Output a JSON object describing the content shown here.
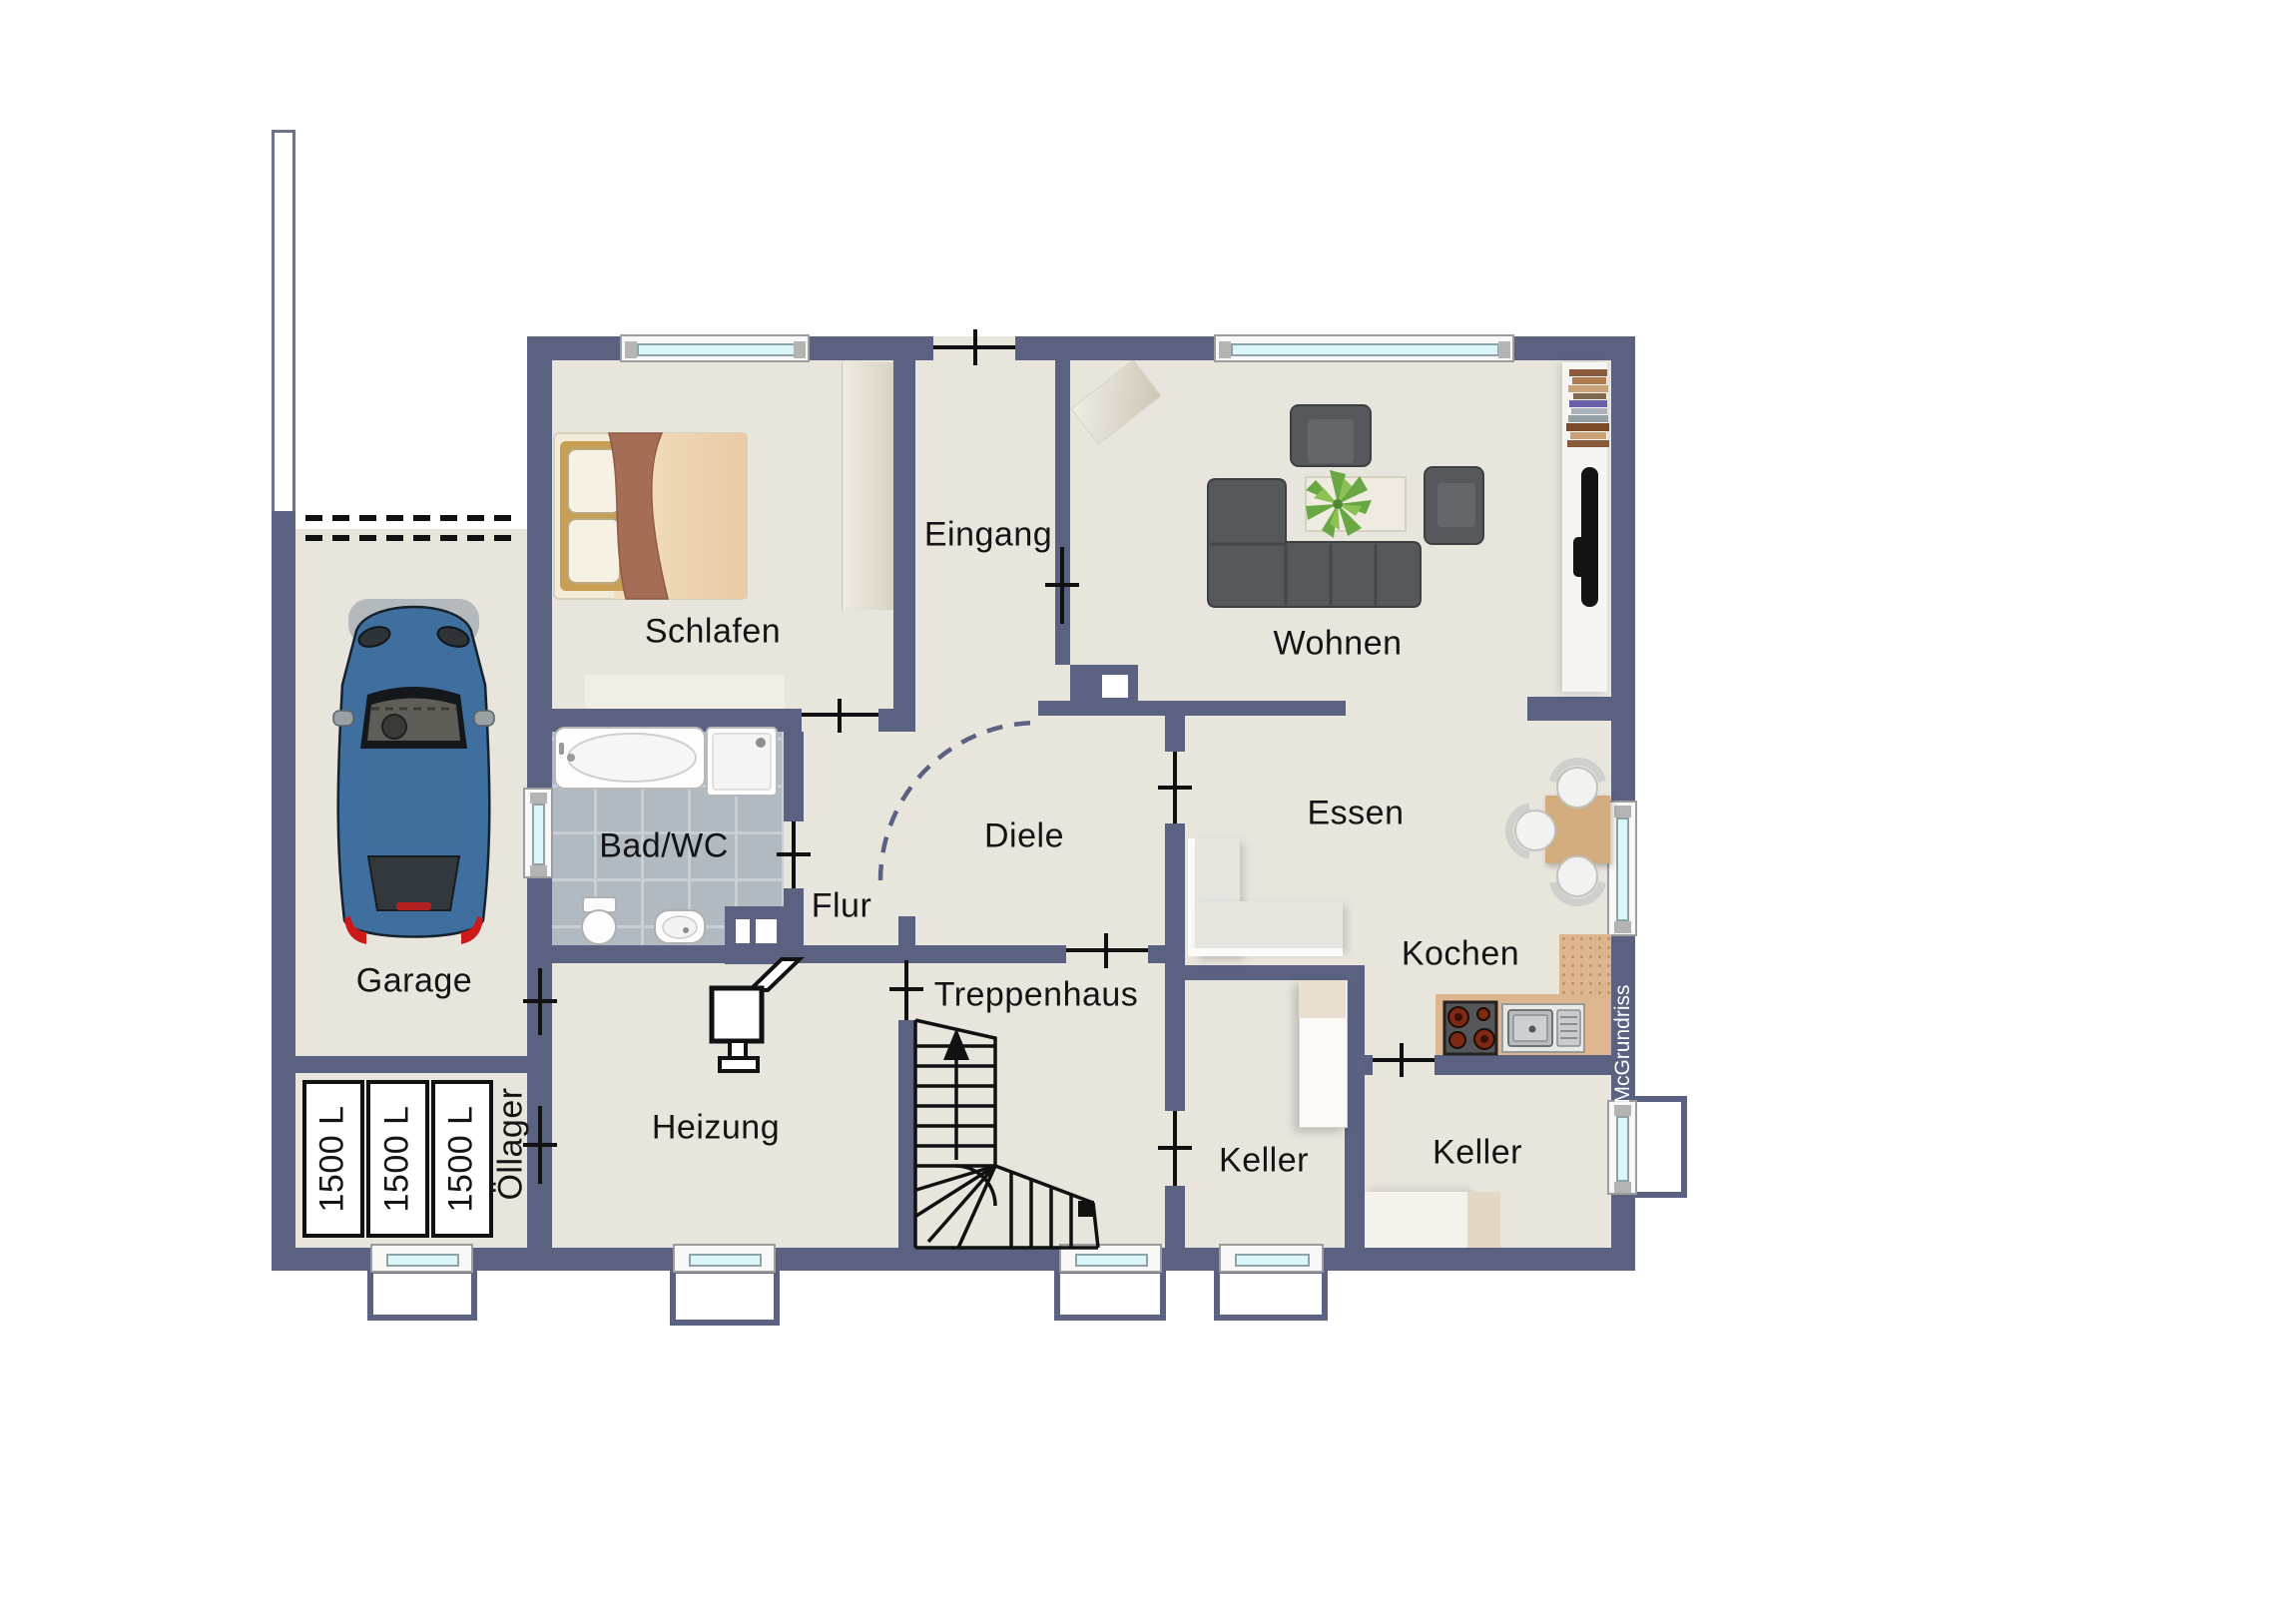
{
  "title": "Grundriss Kellergeschoss",
  "watermark": "McGrundriss",
  "rooms": {
    "garage": {
      "label": "Garage"
    },
    "schlafen": {
      "label": "Schlafen"
    },
    "eingang": {
      "label": "Eingang"
    },
    "wohnen": {
      "label": "Wohnen"
    },
    "bad_wc": {
      "label": "Bad/WC"
    },
    "flur": {
      "label": "Flur"
    },
    "diele": {
      "label": "Diele"
    },
    "essen": {
      "label": "Essen"
    },
    "kochen": {
      "label": "Kochen"
    },
    "heizung": {
      "label": "Heizung"
    },
    "treppenhaus": {
      "label": "Treppenhaus"
    },
    "keller_1": {
      "label": "Keller"
    },
    "keller_2": {
      "label": "Keller"
    },
    "oellager": {
      "label": "Öllager"
    }
  },
  "tanks": [
    {
      "label": "1500 L"
    },
    {
      "label": "1500 L"
    },
    {
      "label": "1500 L"
    }
  ],
  "colors": {
    "wall": "#5a6181",
    "floor": "#e8e5dd",
    "tile": "#b2bac1",
    "tileline": "#c9d0d5",
    "glass": "#dbf6fa",
    "winframe": "#f8f8f8",
    "outline": "#111111",
    "labelcolor": "#141414",
    "counter": "#ddb58e",
    "table": "#d2ab7e",
    "sofa": "#56585b",
    "bench": "#e6e5e0",
    "blanket": "#a56d55",
    "car_body": "#3e6f9e",
    "plant": "#6aa844"
  }
}
